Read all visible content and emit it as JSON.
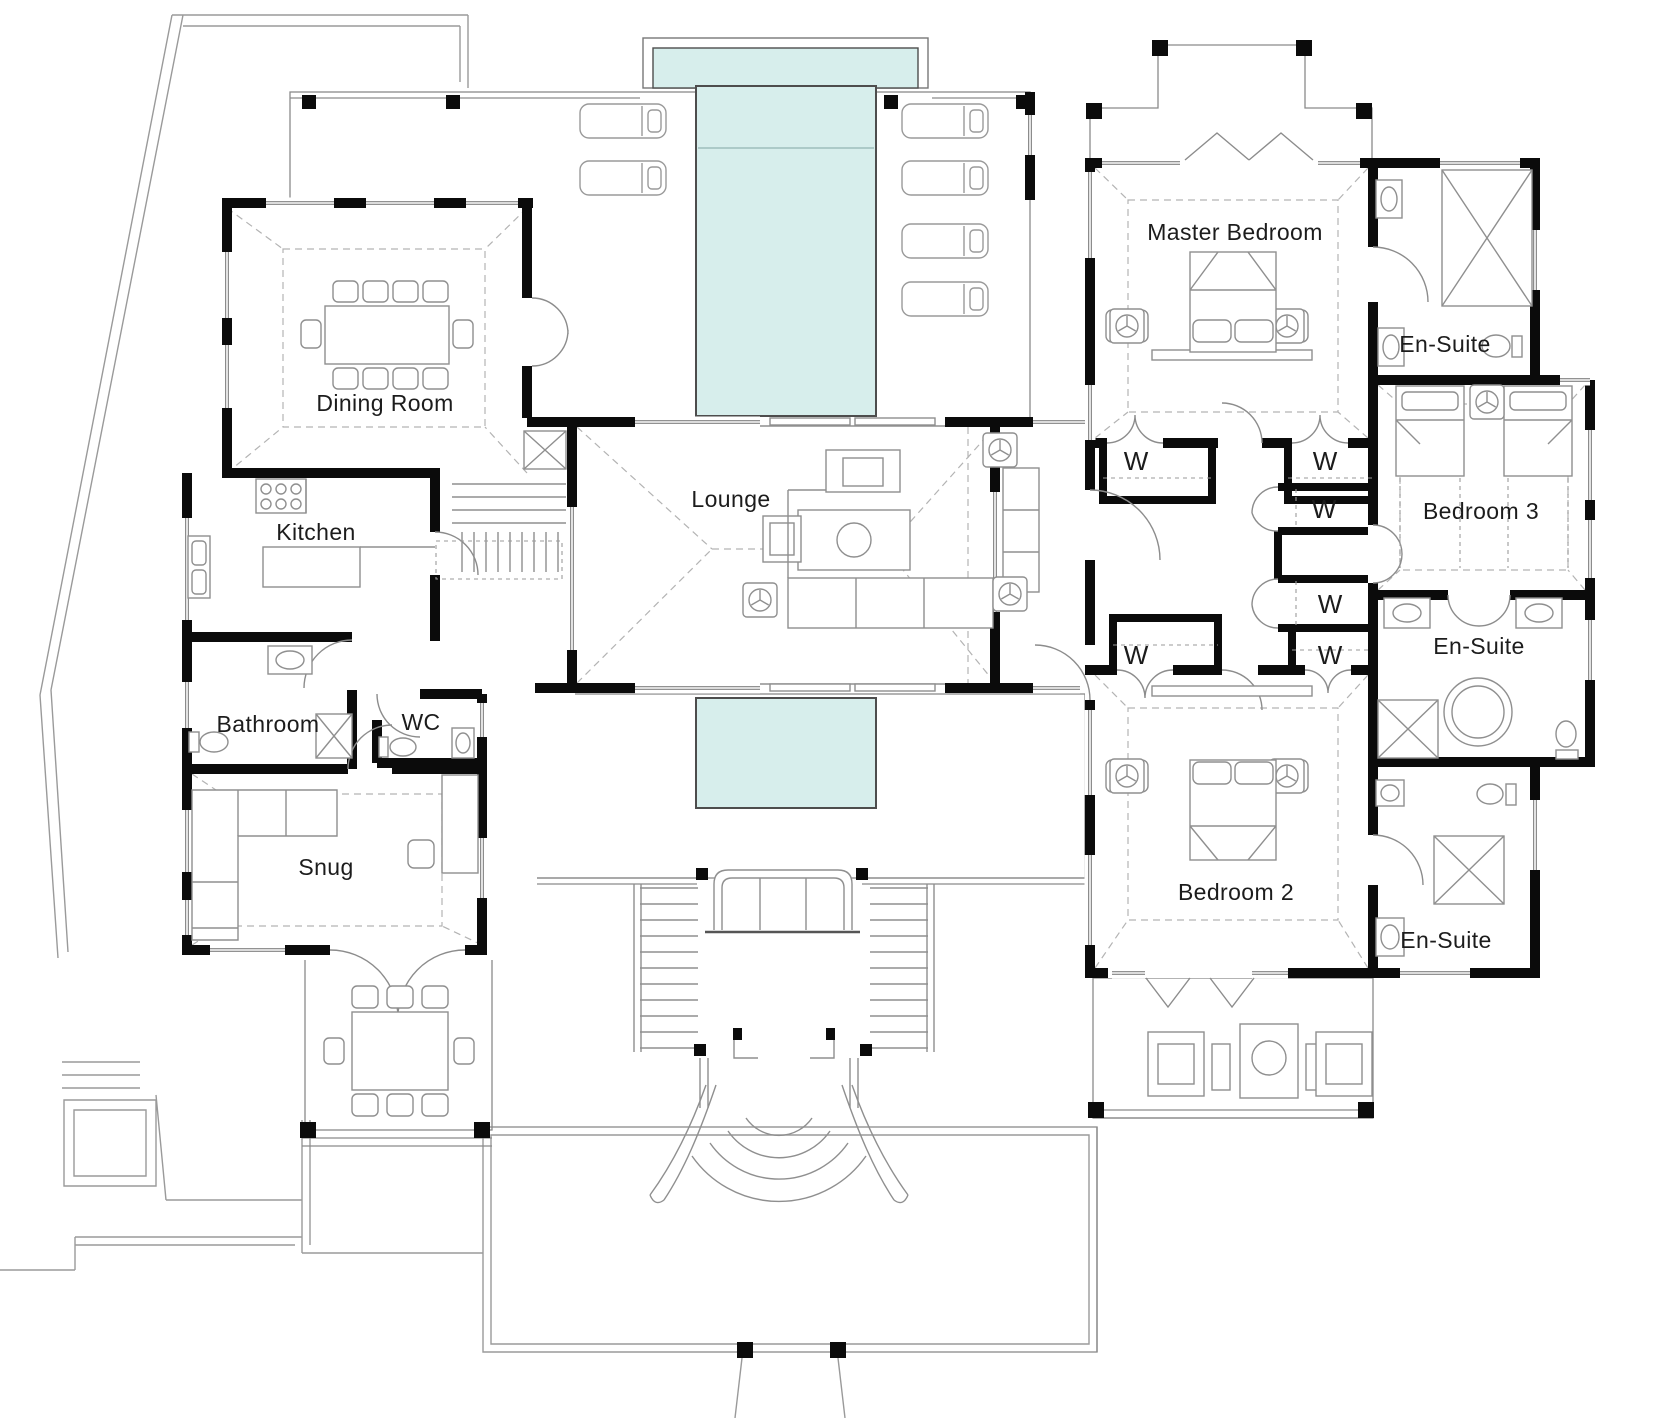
{
  "document": {
    "kind": "architectural-floor-plan",
    "storey": "ground floor villa plan"
  },
  "colors": {
    "pool": "#d7eeec",
    "pool_stroke": "#4d4d4d",
    "wall": "#0b0b0b",
    "thin_line": "#8f8f8f",
    "tile_line": "#cccccc"
  },
  "labels": {
    "dining": "Dining Room",
    "kitchen": "Kitchen",
    "bathroom": "Bathroom",
    "wc": "WC",
    "snug": "Snug",
    "lounge": "Lounge",
    "master": "Master Bedroom",
    "ensuite": "En-Suite",
    "bedroom3": "Bedroom 3",
    "bedroom2": "Bedroom 2",
    "wardrobe": "W"
  },
  "features": {
    "pools": [
      "top pool with header trough",
      "lower plunge pool"
    ],
    "wardrobe_count": 6,
    "ensuite_count": 3,
    "sun_loungers": 6
  }
}
